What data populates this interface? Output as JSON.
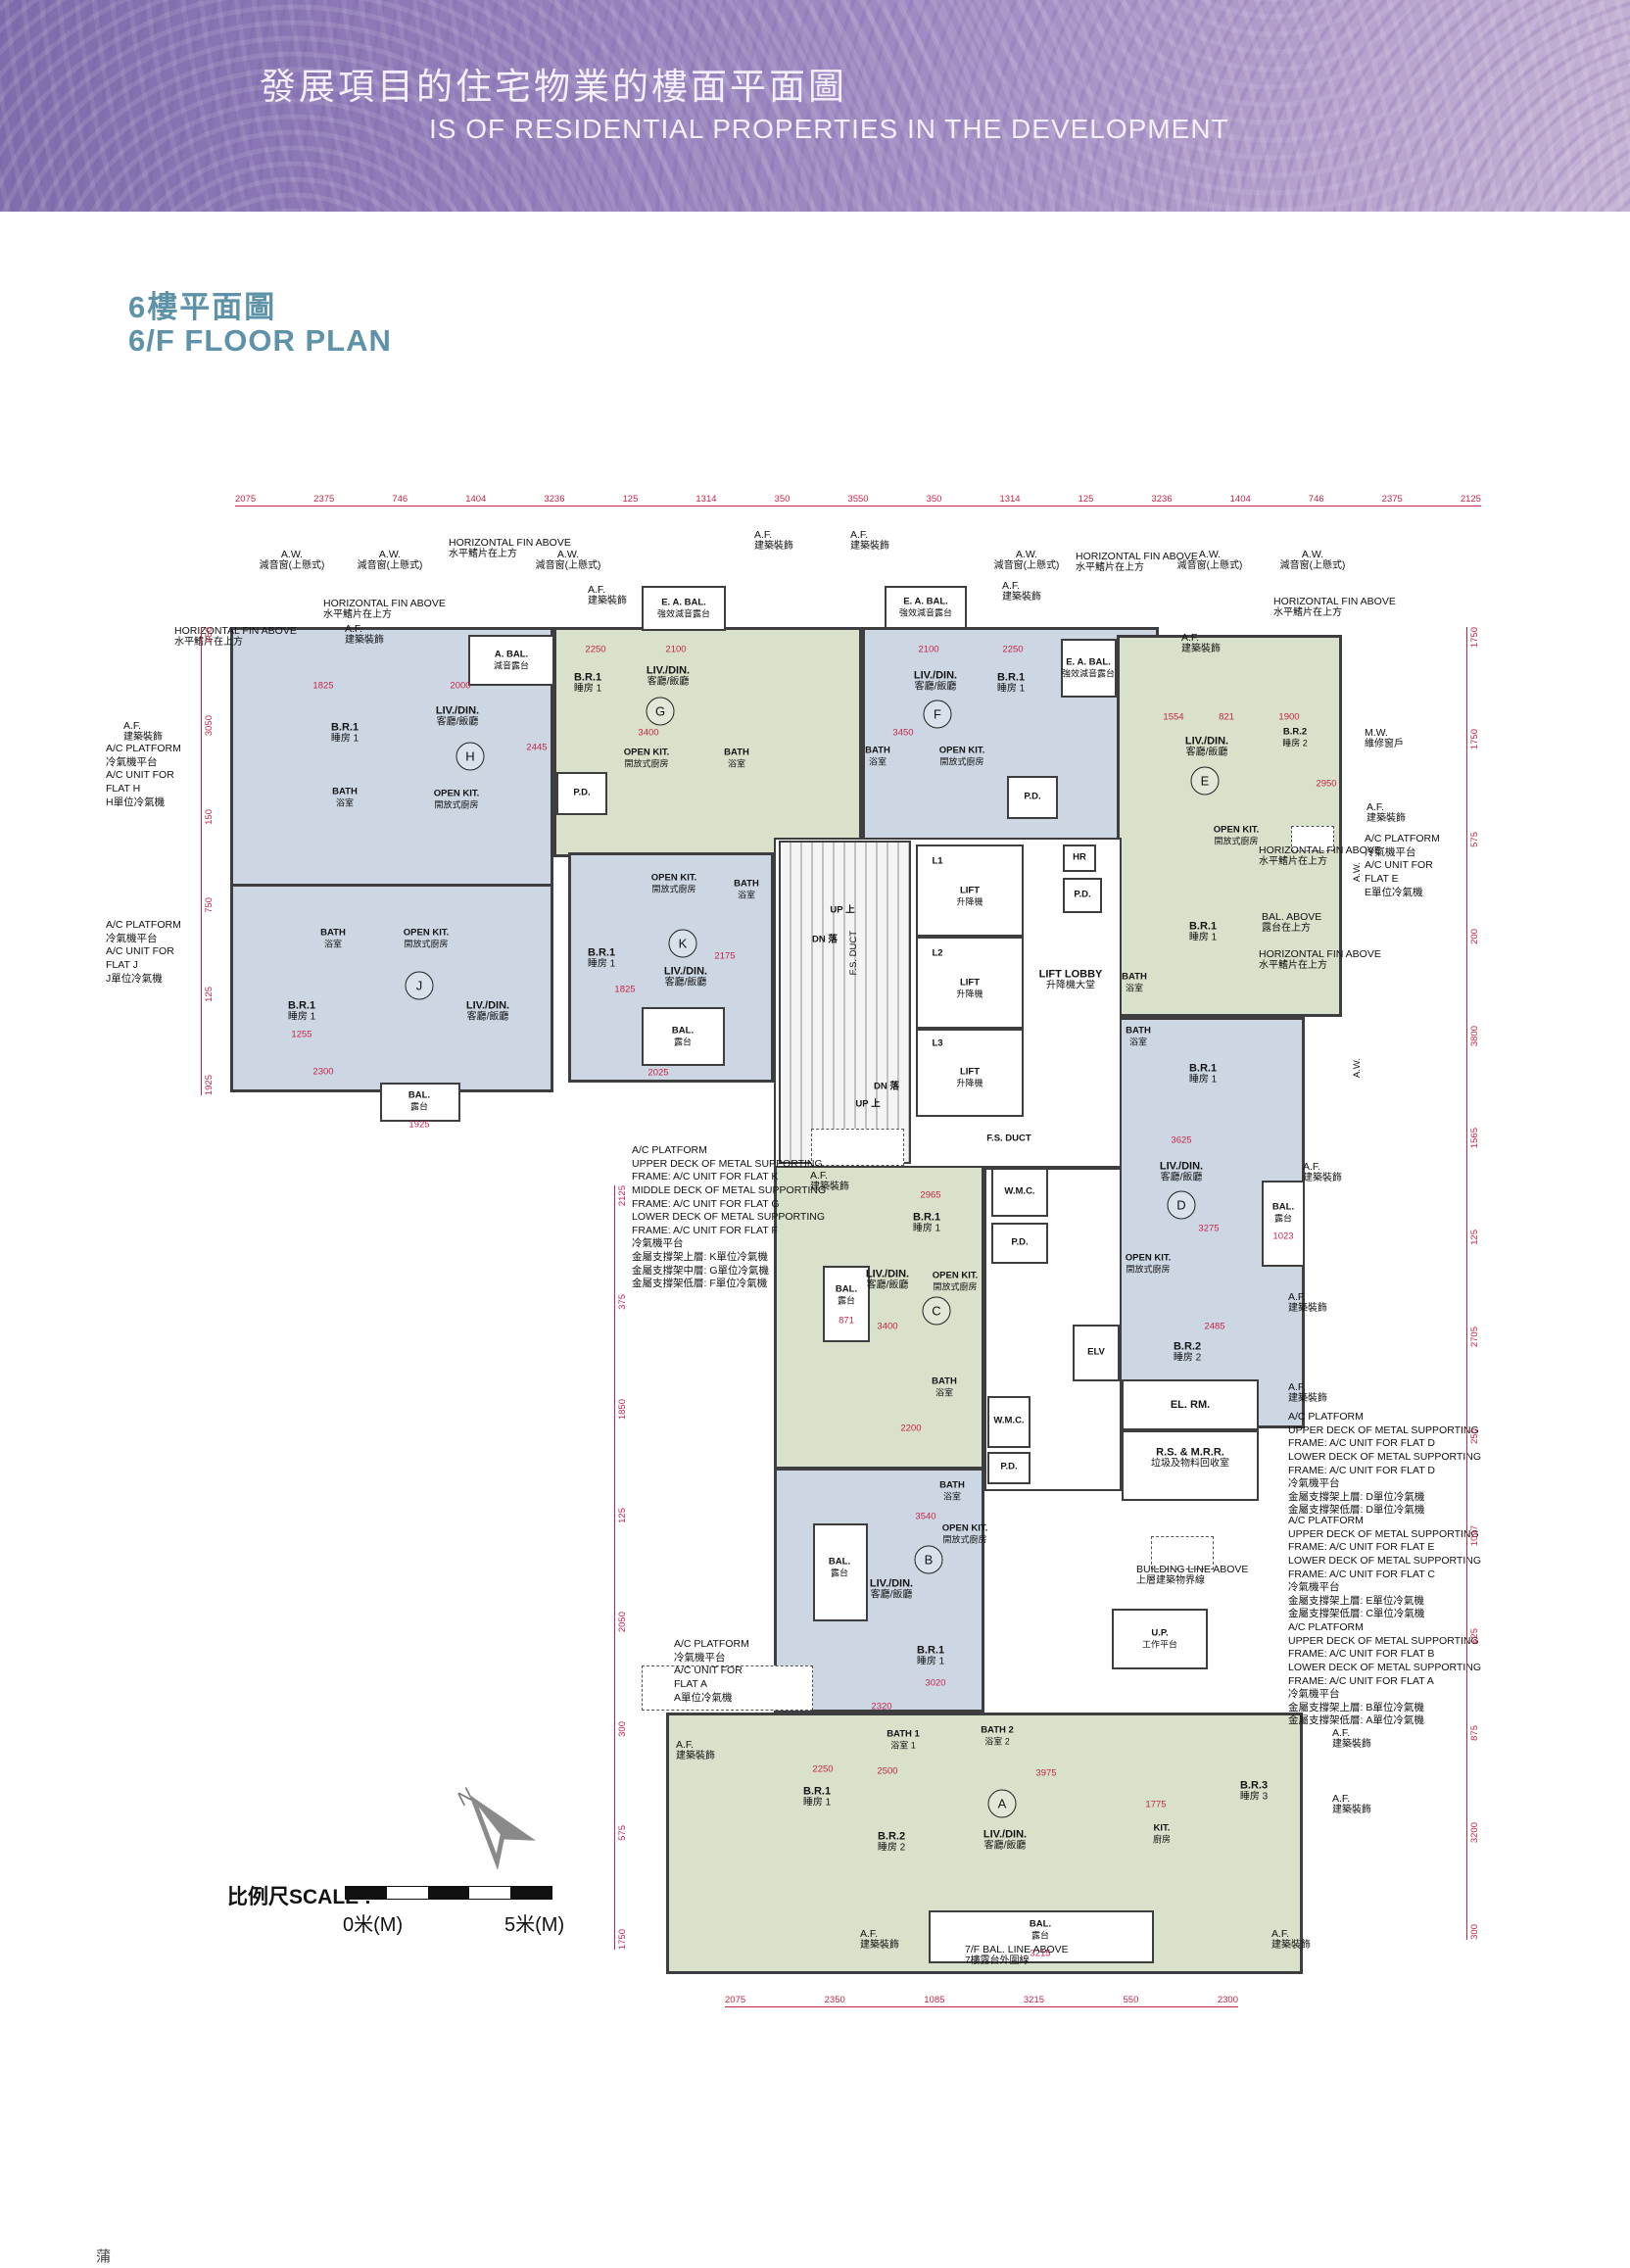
{
  "header": {
    "title_zh": "發展項目的住宅物業的樓面平面圖",
    "title_en": "IS OF RESIDENTIAL PROPERTIES IN THE DEVELOPMENT"
  },
  "section": {
    "title_zh": "6樓平面圖",
    "title_en": "6/F FLOOR PLAN"
  },
  "colors": {
    "accent_teal": "#5e92a8",
    "banner_purple": "#9b86c0",
    "flat_blue": "#cdd7e3",
    "flat_green": "#d9e1cb",
    "wall": "#3e3e40",
    "dim_red": "#c42649"
  },
  "labels": {
    "livdin": {
      "en": "LIV./DIN.",
      "zh": "客廳/飯廳"
    },
    "br1": {
      "en": "B.R.1",
      "zh": "睡房 1"
    },
    "br2": {
      "en": "B.R.2",
      "zh": "睡房 2"
    },
    "br3": {
      "en": "B.R.3",
      "zh": "睡房 3"
    },
    "bath": {
      "en": "BATH",
      "zh": "浴室"
    },
    "bath1": {
      "en": "BATH 1",
      "zh": "浴室 1"
    },
    "bath2": {
      "en": "BATH 2",
      "zh": "浴室 2"
    },
    "openkit": {
      "en": "OPEN KIT.",
      "zh": "開放式廚房"
    },
    "kit": {
      "en": "KIT.",
      "zh": "廚房"
    },
    "bal": {
      "en": "BAL.",
      "zh": "露台"
    },
    "up_platform": {
      "en": "U.P.",
      "zh": "工作平台"
    },
    "af": {
      "en": "A.F.",
      "zh": "建築裝飾"
    },
    "aw": {
      "en": "A.W.",
      "zh": "減音窗(上懸式)"
    },
    "hfa": {
      "en": "HORIZONTAL FIN ABOVE",
      "zh": "水平鰭片在上方"
    },
    "abal": {
      "en": "A. BAL.",
      "zh": "減音露台"
    },
    "eabal": {
      "en": "E. A. BAL.",
      "zh": "強效減音露台"
    },
    "bal_above": {
      "en": "BAL. ABOVE",
      "zh": "露台在上方"
    },
    "mw": {
      "en": "M.W.",
      "zh": "維修窗戶"
    },
    "building_line": {
      "en": "BUILDING LINE ABOVE",
      "zh": "上層建築物界線"
    },
    "bal7f": {
      "en": "7/F BAL. LINE ABOVE",
      "zh": "7樓露台外圍線"
    },
    "pd": "P.D."
  },
  "flats": {
    "a": {
      "letter": "A",
      "dims": [
        "2250",
        "2500",
        "3975",
        "1775",
        "3215"
      ]
    },
    "b": {
      "letter": "B",
      "dims": [
        "3540",
        "3020",
        "2320"
      ]
    },
    "c": {
      "letter": "C",
      "dims": [
        "2965",
        "3400",
        "2200",
        "871"
      ]
    },
    "d": {
      "letter": "D",
      "dims": [
        "3625",
        "3275",
        "2485",
        "1023"
      ]
    },
    "e": {
      "letter": "E",
      "dims": [
        "1554",
        "821",
        "1900",
        "2950"
      ]
    },
    "f": {
      "letter": "F",
      "dims": [
        "2100",
        "2250",
        "3450"
      ]
    },
    "g": {
      "letter": "G",
      "dims": [
        "2250",
        "2100",
        "3400"
      ]
    },
    "h": {
      "letter": "H",
      "dims": [
        "1825",
        "2000",
        "2445"
      ]
    },
    "j": {
      "letter": "J",
      "dims": [
        "1255",
        "1925",
        "2300"
      ]
    },
    "k": {
      "letter": "K",
      "dims": [
        "2175",
        "1825",
        "2025"
      ]
    }
  },
  "core": {
    "lifts": [
      "L1",
      "L2",
      "L3"
    ],
    "lift_en": "LIFT",
    "lift_zh": "升降機",
    "lobby_en": "LIFT LOBBY",
    "lobby_zh": "升降機大堂",
    "fs_duct": "F.S. DUCT",
    "hr": "HR",
    "pd": "P.D.",
    "elv": "ELV",
    "el_rm": "EL. RM.",
    "rs_mrr_en": "R.S. & M.R.R.",
    "rs_mrr_zh": "垃圾及物料回收室",
    "wmc": "W.M.C.",
    "up": "UP",
    "up_zh": "上",
    "dn": "DN",
    "dn_zh": "落"
  },
  "callouts": {
    "ac_h": {
      "lines": [
        "A/C PLATFORM",
        "冷氣機平台",
        "A/C UNIT FOR",
        "FLAT H",
        "H單位冷氣機"
      ]
    },
    "ac_j": {
      "lines": [
        "A/C PLATFORM",
        "冷氣機平台",
        "A/C UNIT FOR",
        "FLAT J",
        "J單位冷氣機"
      ]
    },
    "ac_e": {
      "lines": [
        "A/C PLATFORM",
        "冷氣機平台",
        "A/C UNIT FOR",
        "FLAT E",
        "E單位冷氣機"
      ]
    },
    "ac_a": {
      "lines": [
        "A/C PLATFORM",
        "冷氣機平台",
        "A/C UNIT FOR",
        "FLAT A",
        "A單位冷氣機"
      ]
    },
    "ac_kgf": {
      "lines": [
        "A/C PLATFORM",
        "UPPER DECK OF METAL SUPPORTING",
        "FRAME: A/C UNIT FOR FLAT K",
        "MIDDLE DECK OF METAL SUPPORTING",
        "FRAME: A/C UNIT FOR FLAT G",
        "LOWER DECK OF METAL SUPPORTING",
        "FRAME: A/C UNIT FOR FLAT F",
        "冷氣機平台",
        "金屬支撐架上層: K單位冷氣機",
        "金屬支撐架中層: G單位冷氣機",
        "金屬支撐架低層: F單位冷氣機"
      ]
    },
    "ac_dd": {
      "lines": [
        "A/C PLATFORM",
        "UPPER DECK OF METAL SUPPORTING",
        "FRAME: A/C UNIT FOR FLAT D",
        "LOWER DECK OF METAL SUPPORTING",
        "FRAME: A/C UNIT FOR FLAT D",
        "冷氣機平台",
        "金屬支撐架上層: D單位冷氣機",
        "金屬支撐架低層: D單位冷氣機"
      ]
    },
    "ac_ec": {
      "lines": [
        "A/C PLATFORM",
        "UPPER DECK OF METAL SUPPORTING",
        "FRAME: A/C UNIT FOR FLAT E",
        "LOWER DECK OF METAL SUPPORTING",
        "FRAME: A/C UNIT FOR FLAT C",
        "冷氣機平台",
        "金屬支撐架上層: E單位冷氣機",
        "金屬支撐架低層: C單位冷氣機"
      ]
    },
    "ac_ba": {
      "lines": [
        "A/C PLATFORM",
        "UPPER DECK OF METAL SUPPORTING",
        "FRAME: A/C UNIT FOR FLAT B",
        "LOWER DECK OF METAL SUPPORTING",
        "FRAME: A/C UNIT FOR FLAT A",
        "冷氣機平台",
        "金屬支撐架上層: B單位冷氣機",
        "金屬支撐架低層: A單位冷氣機"
      ]
    }
  },
  "dims": {
    "top": [
      "2075",
      "2375",
      "746",
      "1404",
      "3236",
      "125",
      "1314",
      "350",
      "3550",
      "350",
      "1314",
      "125",
      "3236",
      "1404",
      "746",
      "2375",
      "2125"
    ],
    "bottom": [
      "2075",
      "2350",
      "1085",
      "3215",
      "550",
      "2300"
    ],
    "left": [
      "250",
      "3050",
      "150",
      "750",
      "125",
      "1925"
    ],
    "mid_left": [
      "2125",
      "375",
      "1850",
      "125",
      "2050",
      "300",
      "575",
      "1750"
    ],
    "right": [
      "1750",
      "1750",
      "575",
      "200",
      "3800",
      "1565",
      "125",
      "2705",
      "250",
      "1097",
      "625",
      "875",
      "3200",
      "300"
    ]
  },
  "scale_bar": {
    "label": "比例尺SCALE :",
    "start": "0米(M)",
    "end": "5米(M)"
  },
  "compass": {
    "n": "N"
  },
  "footer_partial": "蒲"
}
